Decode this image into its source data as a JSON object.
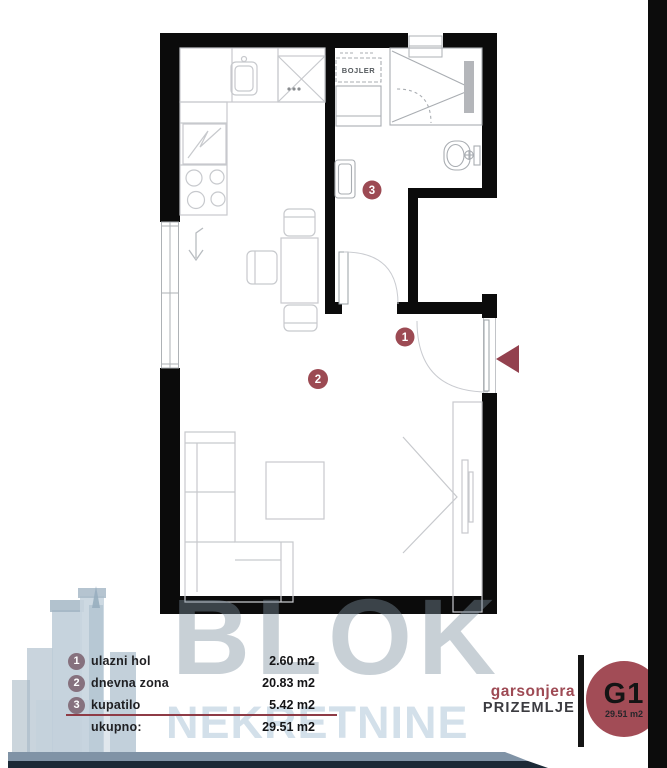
{
  "floor_plan": {
    "boiler_label": "BOJLER",
    "markers": {
      "m1": "1",
      "m2": "2",
      "m3": "3"
    }
  },
  "legend": {
    "rows": [
      {
        "number": "1",
        "label": "ulazni hol",
        "area": "2.60 m2"
      },
      {
        "number": "2",
        "label": "dnevna zona",
        "area": "20.83 m2"
      },
      {
        "number": "3",
        "label": "kupatilo",
        "area": "5.42 m2"
      }
    ],
    "total_label": "ukupno:",
    "total_area": "29.51 m2"
  },
  "badge": {
    "unit_type": "garsonjera",
    "floor": "PRIZEMLJE",
    "unit_code": "G1",
    "unit_area": "29.51 m2"
  },
  "watermark": {
    "primary": "BLOK",
    "secondary": "NEKRETNINE"
  },
  "colors": {
    "wall": "#0b0b0b",
    "marker_maroon": "#9c4a53",
    "entry_arrow_maroon": "#93414e",
    "legend_circle_mauve": "#86717e",
    "accent_maroon": "#9e4a54",
    "underline_maroon": "#8e3b46",
    "watermark_gray": "#7e909f",
    "watermark_blue": "#cfdde8",
    "band_blue": "#8093a6",
    "band_navy": "#1c2a37"
  }
}
